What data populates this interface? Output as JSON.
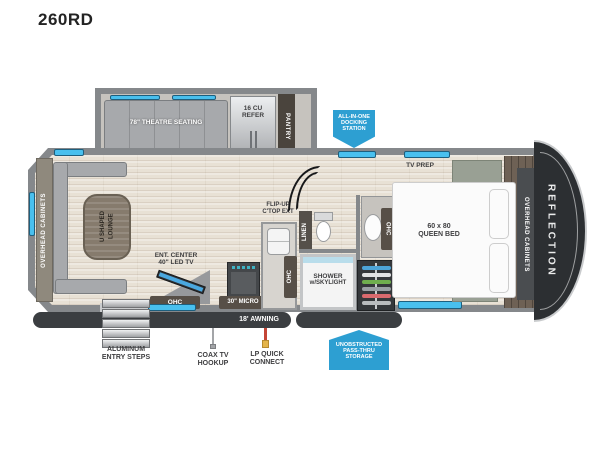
{
  "title": "260RD",
  "colors": {
    "badge_blue": "#2d9fd2",
    "window_blue": "#49c0ee",
    "wall_gray": "#85888b",
    "front_cap_dark": "#2c2f32",
    "floor_tan": "#e8e1d5"
  },
  "labels": {
    "theatre": "78\" THEATRE SEATING",
    "refer_l1": "16 CU",
    "refer_l2": "REFER",
    "pantry": "PANTRY",
    "overhead_cabinets": "OVERHEAD CABINETS",
    "lounge_l1": "U SHAPED",
    "lounge_l2": "LOUNGE",
    "ent_l1": "ENT. CENTER",
    "ent_l2": "40\" LED TV",
    "ohc": "OHC",
    "micro": "30\" MICRO",
    "flip_l1": "FLIP-UP",
    "flip_l2": "C'TOP EXT",
    "linen": "LINEN",
    "shower_l1": "SHOWER",
    "shower_l2": "w/SKYLIGHT",
    "tv_prep": "TV PREP",
    "bed_l1": "60 x 80",
    "bed_l2": "QUEEN BED",
    "brand": "REFLECTION",
    "awning": "18' AWNING",
    "steps_l1": "ALUMINUM",
    "steps_l2": "ENTRY STEPS",
    "coax_l1": "COAX TV",
    "coax_l2": "HOOKUP",
    "lp_l1": "LP QUICK",
    "lp_l2": "CONNECT",
    "dock_l1": "ALL-IN-ONE",
    "dock_l2": "DOCKING",
    "dock_l3": "STATION",
    "storage_l1": "UNOBSTRUCTED",
    "storage_l2": "PASS-THRU",
    "storage_l3": "STORAGE"
  }
}
